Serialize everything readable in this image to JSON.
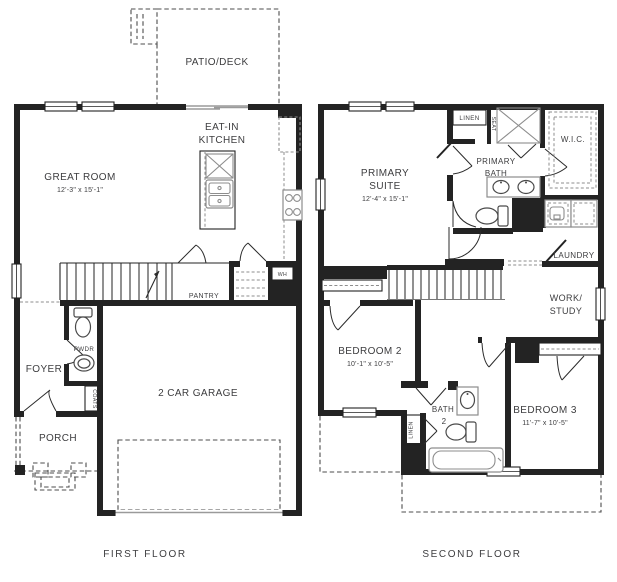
{
  "document": {
    "type": "two-story-house-floor-plan"
  },
  "colors": {
    "wall": "#232323",
    "fixture": "#8d8d8d",
    "dashed": "#4d4d4d",
    "text": "#3d3d3f",
    "background": "#ffffff"
  },
  "first_floor": {
    "title": "FIRST FLOOR",
    "labels": {
      "patio_deck": "PATIO/DECK",
      "eat_in_1": "EAT-IN",
      "eat_in_2": "KITCHEN",
      "great_room": "GREAT ROOM",
      "great_room_dims": "12'-3\" x 15'-1\"",
      "pantry": "PANTRY",
      "water_heater": "WH",
      "powder": "PWDR",
      "foyer": "FOYER",
      "coats": "COATS",
      "porch": "PORCH",
      "garage": "2 CAR GARAGE"
    }
  },
  "second_floor": {
    "title": "SECOND FLOOR",
    "labels": {
      "primary_suite_1": "PRIMARY",
      "primary_suite_2": "SUITE",
      "primary_suite_dims": "12'-4\" x 15'-1\"",
      "linen_upper": "LINEN",
      "seat": "SEAT",
      "wic": "W.I.C.",
      "primary_bath_1": "PRIMARY",
      "primary_bath_2": "BATH",
      "laundry": "LAUNDRY",
      "work_study_1": "WORK/",
      "work_study_2": "STUDY",
      "bedroom2": "BEDROOM 2",
      "bedroom2_dims": "10'-1\" x 10'-5\"",
      "bath2_1": "BATH",
      "bath2_2": "2",
      "linen_hall": "LINEN",
      "bedroom3": "BEDROOM 3",
      "bedroom3_dims": "11'-7\" x 10'-5\""
    }
  }
}
